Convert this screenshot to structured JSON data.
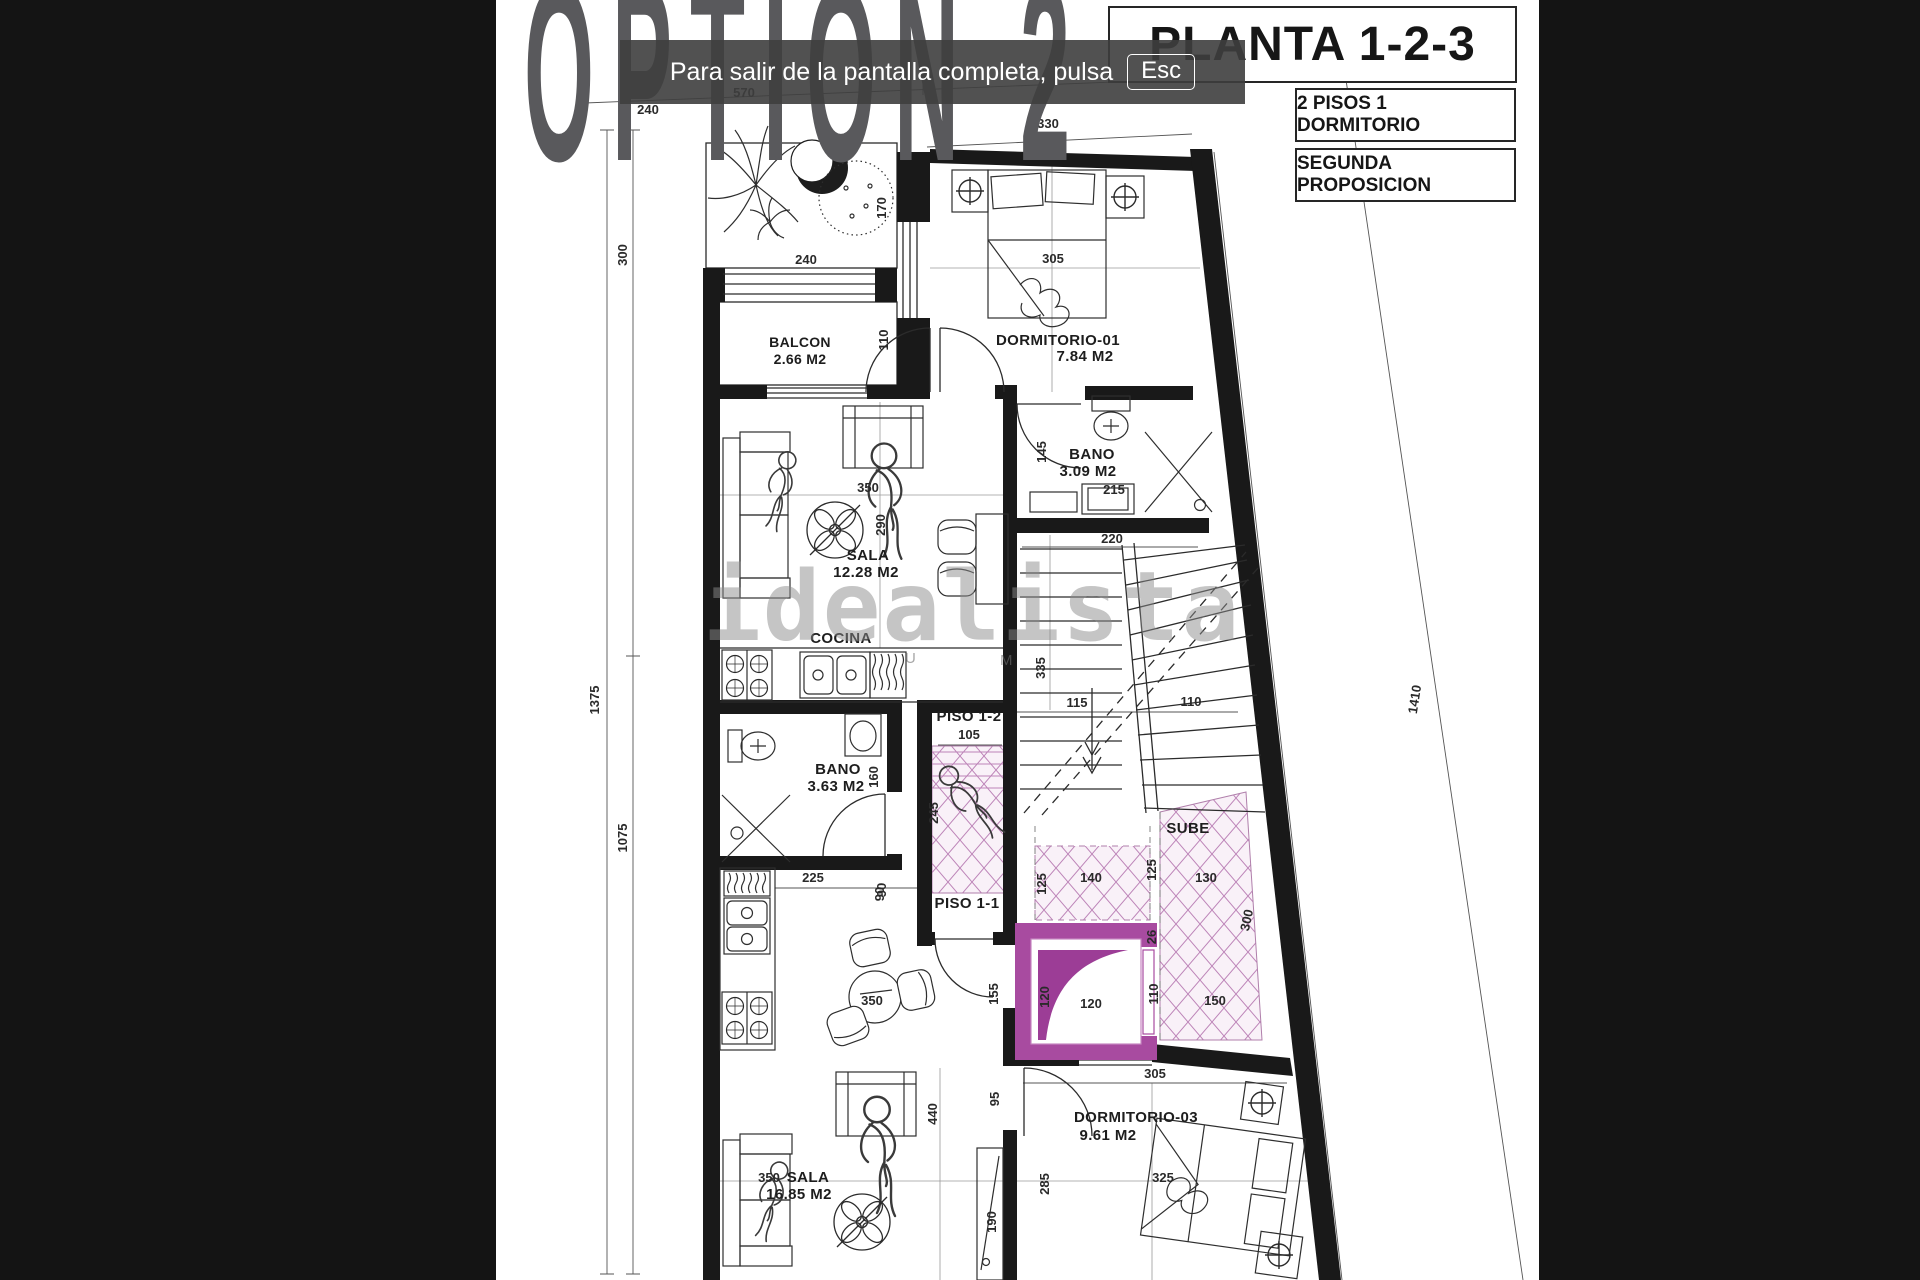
{
  "toast": {
    "message": "Para salir de la pantalla completa, pulsa",
    "key": "Esc"
  },
  "title": "OPTION 2",
  "panel": {
    "plan_title": "PLANTA 1-2-3",
    "line1": "2 PISOS 1 DORMITORIO",
    "line2": "SEGUNDA PROPOSICION"
  },
  "brand_watermark": "idealista",
  "watermark_fragments": {
    "left": "U",
    "right": "M"
  },
  "rooms": {
    "balcon": {
      "name": "BALCON",
      "area": "2.66 M2"
    },
    "dorm01": {
      "name": "DORMITORIO-01",
      "area": "7.84 M2"
    },
    "bano1": {
      "name": "BANO",
      "area": "3.09 M2"
    },
    "sala1": {
      "name": "SALA",
      "area": "12.28 M2"
    },
    "cocina": {
      "name": "COCINA"
    },
    "bano2": {
      "name": "BANO",
      "area": "3.63 M2"
    },
    "piso12": {
      "name": "PISO 1-2"
    },
    "piso11": {
      "name": "PISO 1-1"
    },
    "sube": {
      "name": "SUBE"
    },
    "dorm03": {
      "name": "DORMITORIO-03",
      "area": "9.61 M2"
    },
    "sala2": {
      "name": "SALA",
      "area": "16.85 M2"
    }
  },
  "dims": {
    "top_240": "240",
    "top_570": "570",
    "top_330": "330",
    "left_300": "300",
    "left_1375": "1375",
    "left_1075": "1075",
    "garden_240": "240",
    "garden_170": "170",
    "dorm01_305": "305",
    "bano1_145": "145",
    "bano1_215": "215",
    "sala1_350": "350",
    "sala1_290": "290",
    "stairs_220": "220",
    "stairs_335": "335",
    "stairs_115": "115",
    "stairs_110": "110",
    "piso12_105": "105",
    "piso12_245": "245",
    "bano2_160": "160",
    "corr_90": "90",
    "corr_155": "155",
    "hatchA_125L": "125",
    "hatchA_140": "140",
    "hatchA_125R": "125",
    "hatchB_130": "130",
    "hatchB_300": "300",
    "hatchB_150": "150",
    "hatchB_26": "26",
    "elev_120v": "120",
    "elev_120h": "120",
    "elev_110": "110",
    "kit2_225": "225",
    "kit2_90": "90",
    "table2_350": "350",
    "sala2_440": "440",
    "sala2_95": "95",
    "sala2_190": "190",
    "sala2_350": "350",
    "dorm03_305": "305",
    "dorm03_285": "285",
    "dorm03_325": "325",
    "right_1410": "1410"
  },
  "colors": {
    "elevator_purple": "#a84ba0",
    "elevator_wedge": "#9c3d96",
    "hatch_pink": "#bd84b8",
    "toast_bg": "#3e3e3e",
    "title_gray": "#59595c"
  }
}
